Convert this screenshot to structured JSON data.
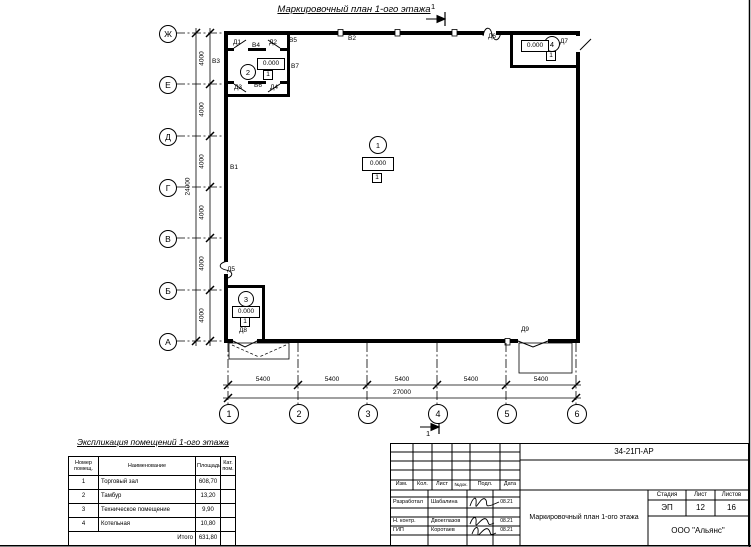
{
  "drawing": {
    "title": "Маркировочный план 1-ого этажа",
    "section_label": "1"
  },
  "axes": {
    "rows": [
      "Ж",
      "Е",
      "Д",
      "Г",
      "В",
      "Б",
      "А"
    ],
    "cols": [
      "1",
      "2",
      "3",
      "4",
      "5",
      "6"
    ],
    "row_step": "4000",
    "row_total": "24000",
    "col_step": "5400",
    "col_total": "27000"
  },
  "marks": {
    "v1": "В1",
    "v2": "В2",
    "v3": "В3",
    "v4": "В4",
    "v5": "В5",
    "v6": "В6",
    "v7": "В7",
    "d1": "Д1",
    "d2": "Д2",
    "d3": "Д3",
    "d4": "Д4",
    "d5": "Д5",
    "d6": "Д6",
    "d7": "Д7",
    "d8": "Д8",
    "d9": "Д9"
  },
  "rooms": {
    "r1": {
      "num": "1",
      "elev": "0.000",
      "floor": "1"
    },
    "r2": {
      "num": "2",
      "elev": "0.000",
      "floor": "1"
    },
    "r3": {
      "num": "3",
      "elev": "0.000",
      "floor": "1"
    },
    "r4": {
      "num": "4",
      "elev": "0.000",
      "floor": "1"
    }
  },
  "explication": {
    "title": "Экспликация помещений 1-ого этажа",
    "headers": [
      "Номер помещ.",
      "Наименование",
      "Площадь",
      "Кат. пом."
    ],
    "rows": [
      {
        "num": "1",
        "name": "Торговый зал",
        "area": "608,70"
      },
      {
        "num": "2",
        "name": "Тамбур",
        "area": "13,20"
      },
      {
        "num": "3",
        "name": "Техническое помещение",
        "area": "9,90"
      },
      {
        "num": "4",
        "name": "Котельная",
        "area": "10,80"
      }
    ],
    "total_label": "Итого",
    "total_area": "631,80"
  },
  "titleblock": {
    "doc_code": "34-21П-АР",
    "rev_headers": [
      "Изм.",
      "Кол.",
      "Лист",
      "№док.",
      "Подл.",
      "Дата"
    ],
    "sign_rows": [
      {
        "role": "Разработал",
        "name": "Шабалина",
        "date": "08.21"
      },
      {
        "role": "Н. контр.",
        "name": "Двоеглазов",
        "date": "08.21"
      },
      {
        "role": "ГИП",
        "name": "Коротаев",
        "date": "08.21"
      }
    ],
    "stage_label": "Стадия",
    "sheet_label": "Лист",
    "sheets_label": "Листов",
    "stage": "ЭП",
    "sheet": "12",
    "sheets": "16",
    "drawing_name": "Маркировочный план 1-ого этажа",
    "org": "ООО \"Альянс\""
  }
}
